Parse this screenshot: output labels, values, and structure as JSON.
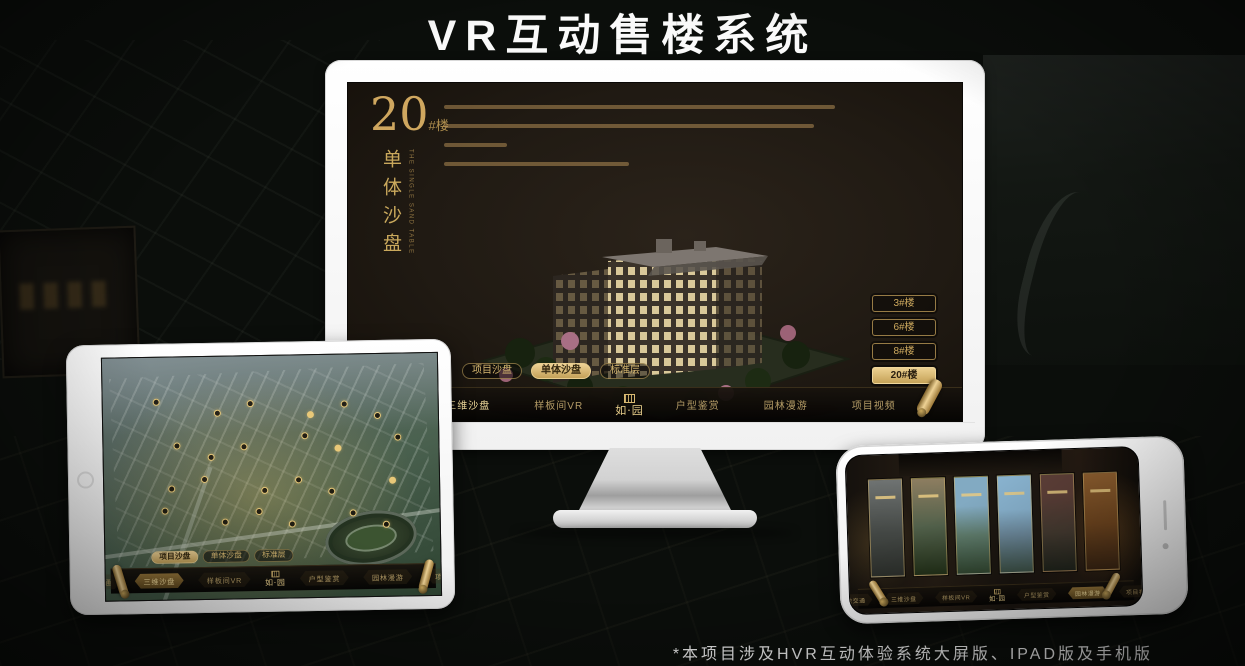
{
  "page": {
    "title": "VR互动售楼系统",
    "footnote": "*本项目涉及HVR互动体验系统大屏版、IPAD版及手机版"
  },
  "app": {
    "logo_text": "如·园",
    "nav_items": [
      "区位交通",
      "三维沙盘",
      "样板间VR",
      "户型鉴赏",
      "园林漫游",
      "项目视频"
    ],
    "tabs": [
      "项目沙盘",
      "单体沙盘",
      "标准层"
    ]
  },
  "monitor_screen": {
    "building_number": "20",
    "building_suffix": "#楼",
    "subtitle": "单体沙盘",
    "subtitle_en": "THE SINGLE SAND TABLE",
    "floor_buttons": [
      "3#楼",
      "6#楼",
      "8#楼",
      "20#楼"
    ],
    "active_floor": "20#楼",
    "active_tab": "单体沙盘",
    "active_nav": "三维沙盘"
  },
  "tablet_screen": {
    "active_tab": "项目沙盘",
    "active_nav": "三维沙盘",
    "badge_count": 24
  },
  "phone_screen": {
    "active_nav": "园林漫游",
    "card_count": 6
  },
  "colors": {
    "gold": "#c9a85c",
    "gold_bright": "#ecd28e",
    "screen_dark": "#201a13",
    "device_white": "#ffffff"
  }
}
